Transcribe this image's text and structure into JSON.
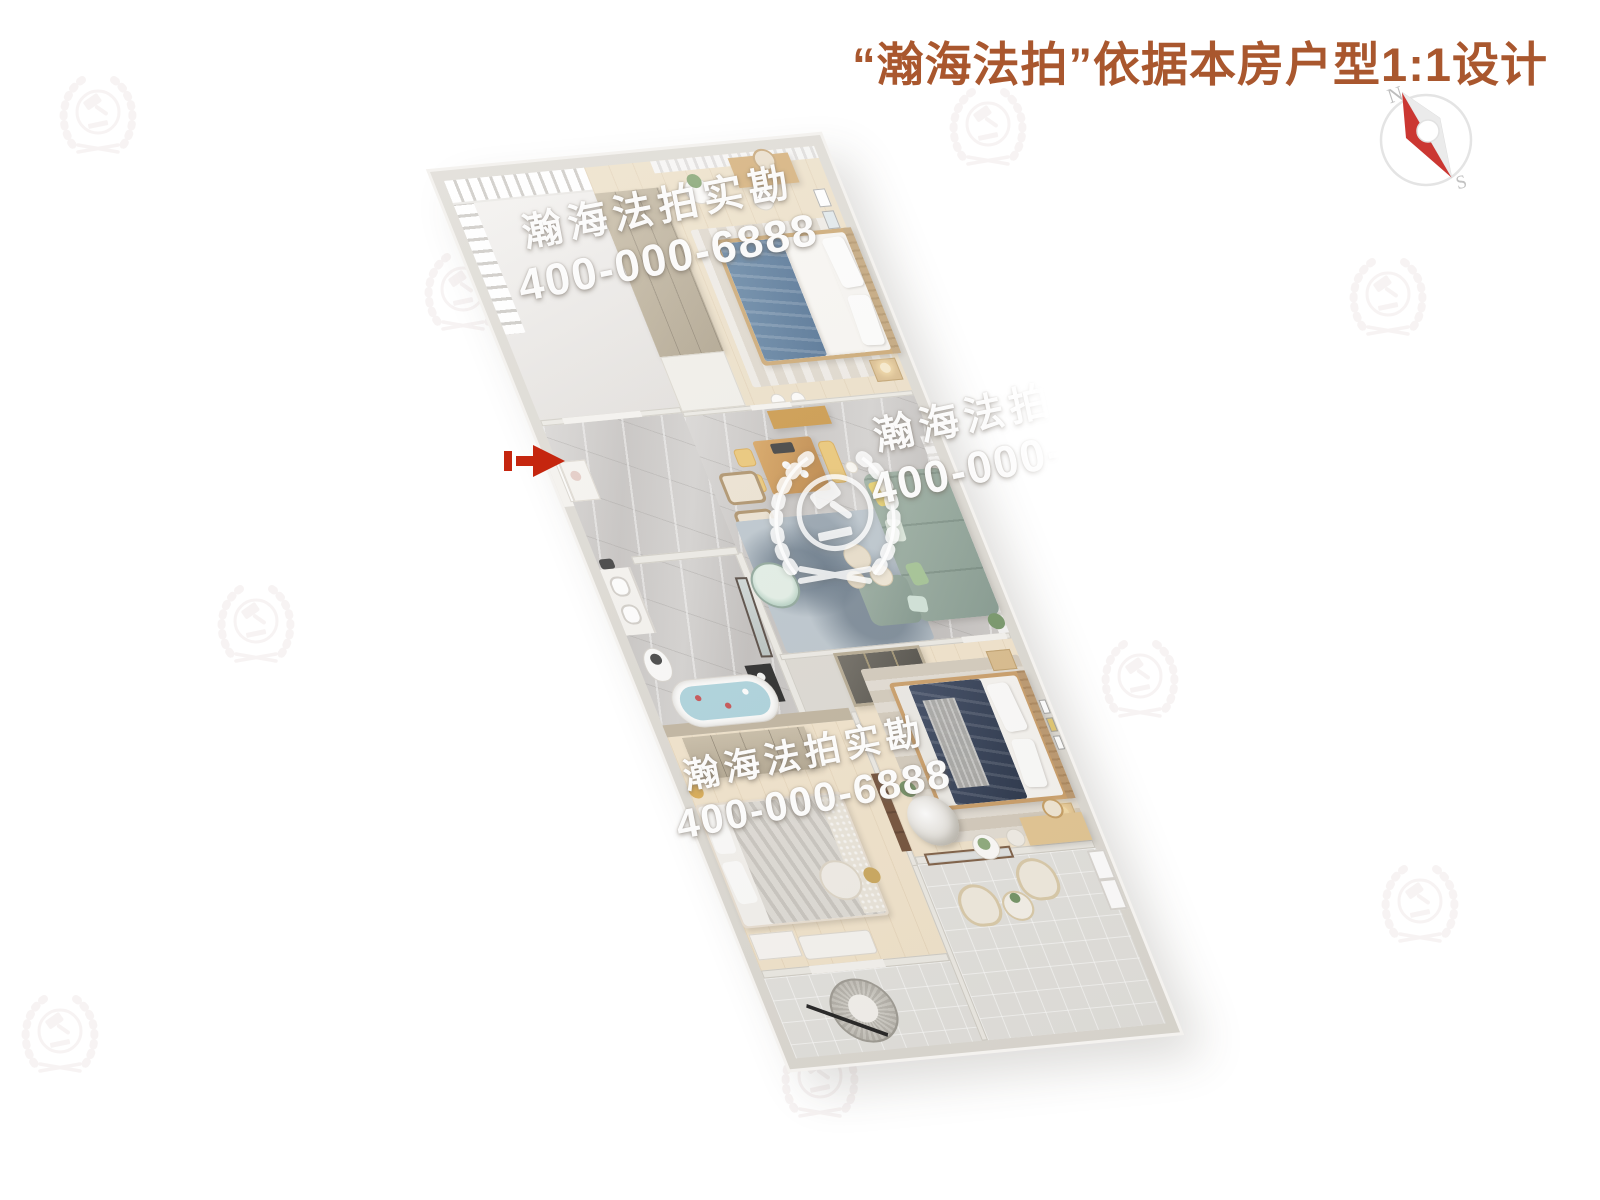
{
  "header": {
    "title": "“瀚海法拍”依据本房户型1:1设计"
  },
  "compass": {
    "north": "N",
    "south": "S"
  },
  "watermark": {
    "brand": "瀚海法拍实勘",
    "phone": "400-000-6888"
  },
  "colors": {
    "title_text": "#a9572e",
    "entrance_arrow": "#c5260f",
    "compass_needle_red": "#cb3732",
    "sofa_green": "#8fa799",
    "bed_navy_duvet": "#2c3850",
    "bed_blue_duvet": "#56789a",
    "marble_floor": "#c8c5c2",
    "wood_floor": "#eddfc6",
    "watermark_text": "#ffffff"
  },
  "icons": {
    "compass": "compass-rose-icon",
    "logo": "laurel-wreath-gavel-icon",
    "entrance": "entrance-arrow-icon"
  }
}
